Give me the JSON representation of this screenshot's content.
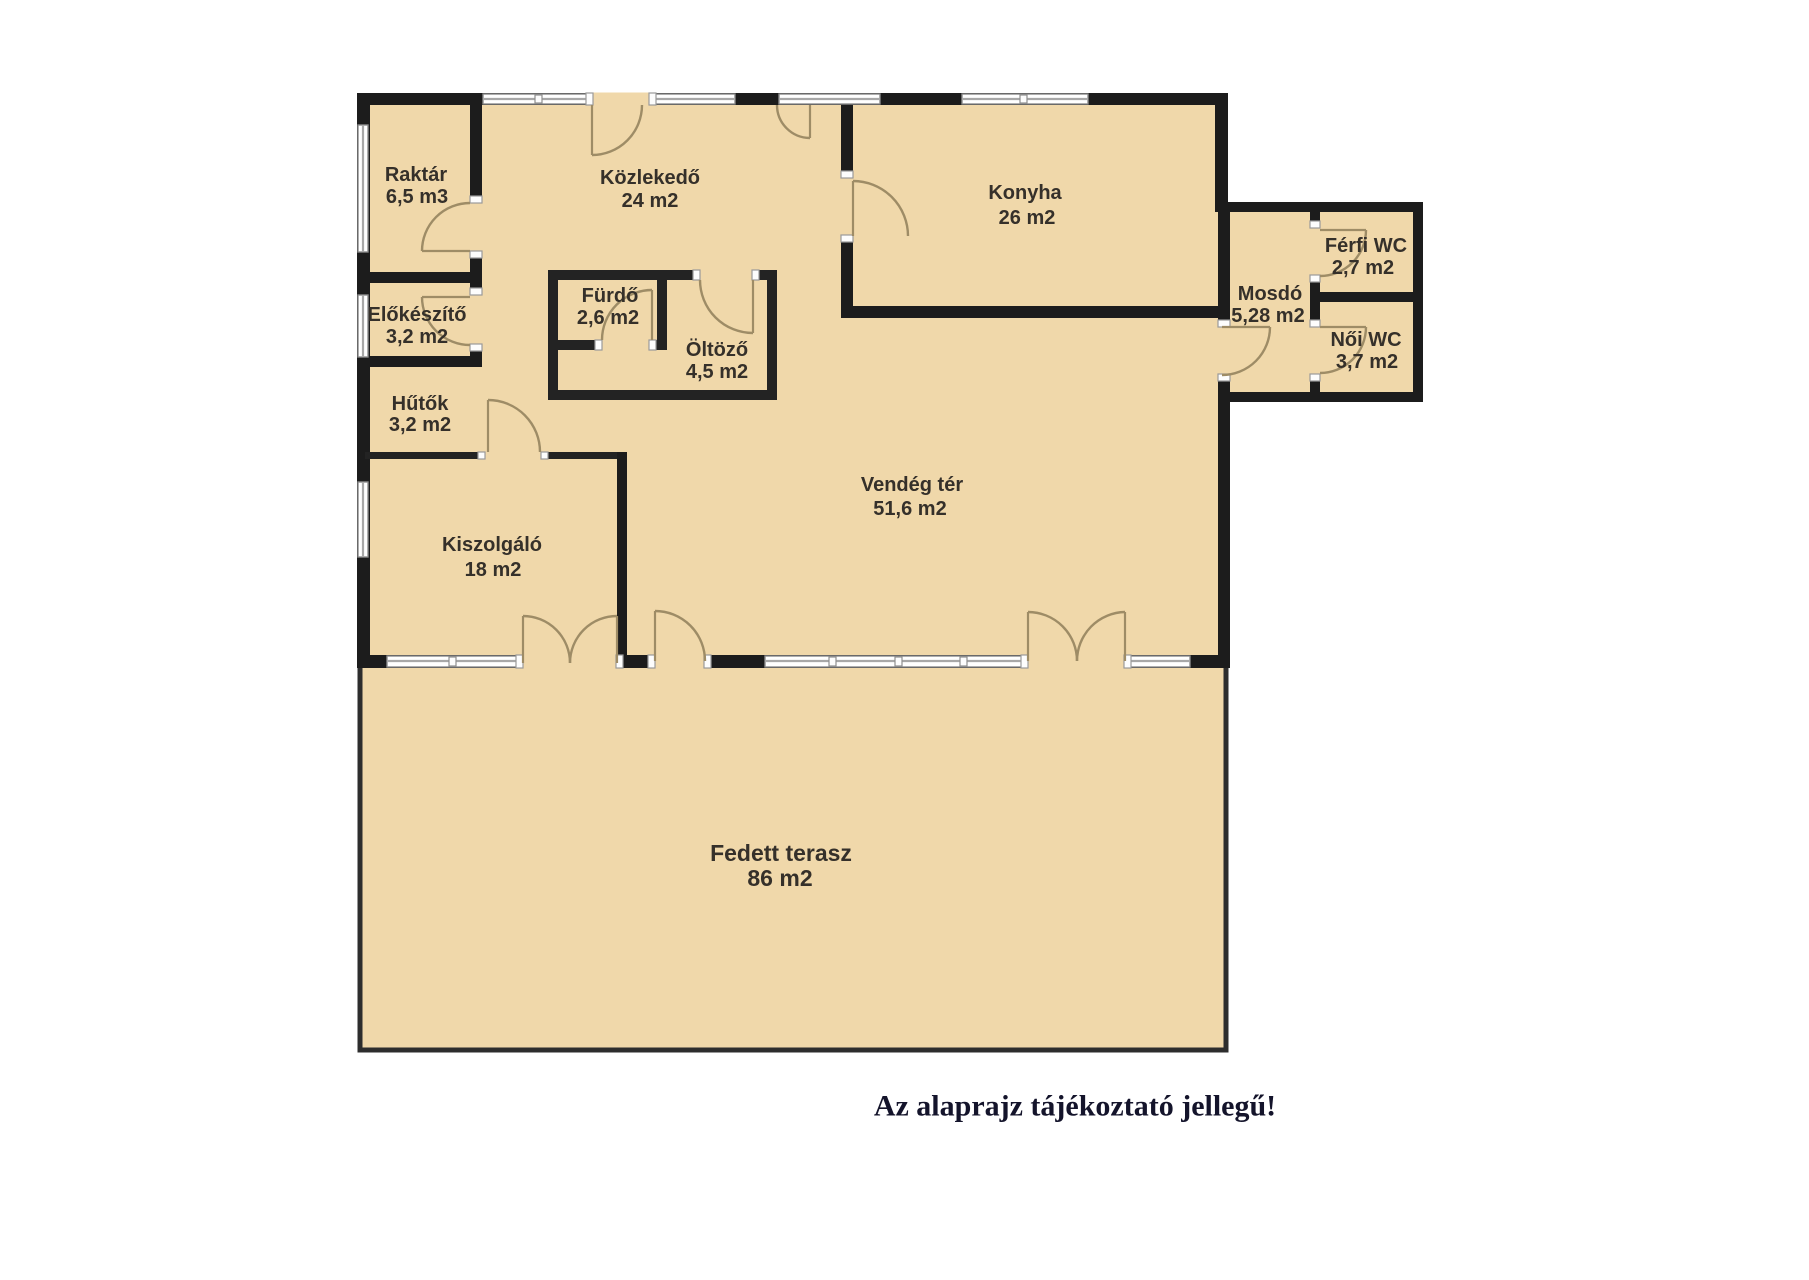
{
  "title": "Alaprajz",
  "caption": "Az alaprajz tájékoztató jellegű!",
  "colors": {
    "floor_fill": "#f0d8aa",
    "wall": "#1c1c1c",
    "door_arc": "#9e8c66",
    "caption_text": "#14142b",
    "background": "#ffffff"
  },
  "rooms": {
    "raktar": {
      "name": "Raktár",
      "area": "6,5 m3"
    },
    "kozlekedo": {
      "name": "Közlekedő",
      "area": "24 m2"
    },
    "konyha": {
      "name": "Konyha",
      "area": "26 m2"
    },
    "elokeszito": {
      "name": "Előkészítő",
      "area": "3,2 m2"
    },
    "furdo": {
      "name": "Fürdő",
      "area": "2,6 m2"
    },
    "oltozo": {
      "name": "Öltöző",
      "area": "4,5 m2"
    },
    "hutok": {
      "name": "Hűtők",
      "area": "3,2 m2"
    },
    "kiszolgalo": {
      "name": "Kiszolgáló",
      "area": "18 m2"
    },
    "vendegter": {
      "name": "Vendég tér",
      "area": "51,6 m2"
    },
    "mosdo": {
      "name": "Mosdó",
      "area": "5,28 m2"
    },
    "ferfiwc": {
      "name": "Férfi WC",
      "area": "2,7 m2"
    },
    "noiwc": {
      "name": "Női WC",
      "area": "3,7 m2"
    },
    "terasz": {
      "name": "Fedett terasz",
      "area": "86 m2"
    }
  }
}
